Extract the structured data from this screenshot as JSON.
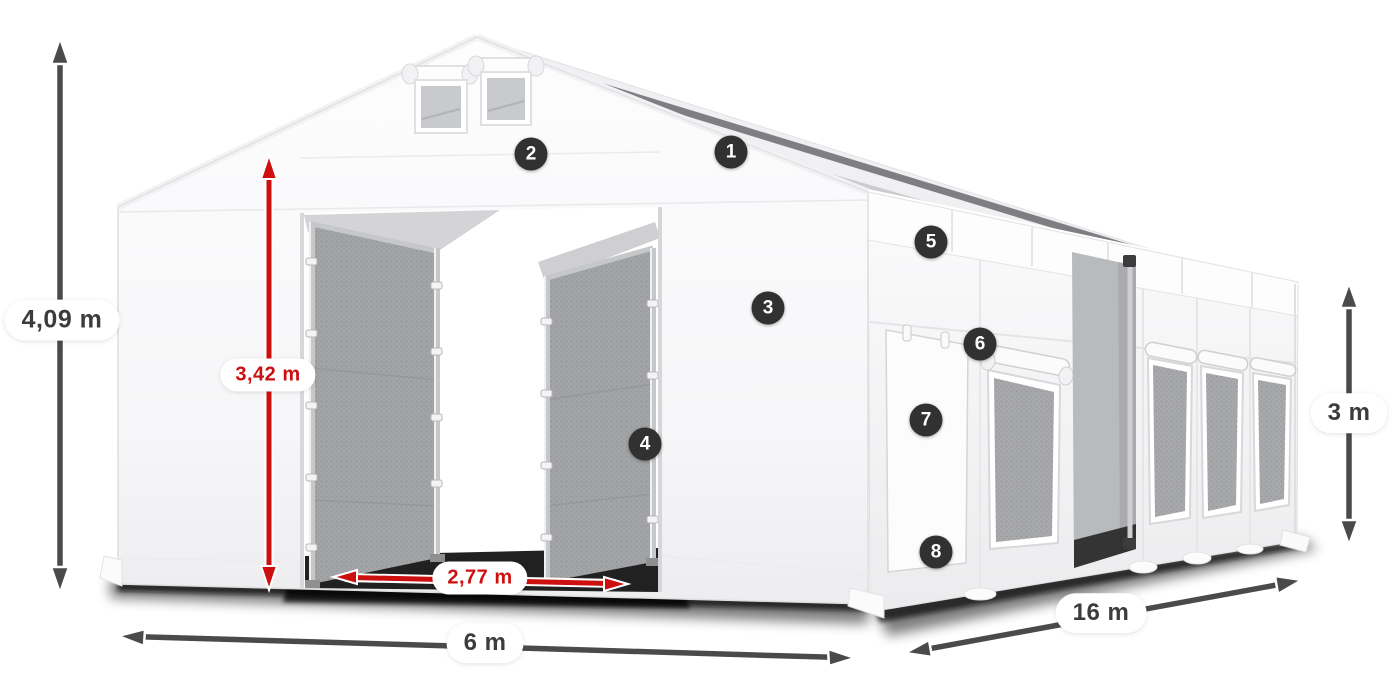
{
  "page": {
    "title": "Tent with dimensions diagram"
  },
  "dimensions": {
    "total_height": "4,09 m",
    "entrance_height": "3,42 m",
    "entrance_width": "2,77 m",
    "front_width": "6 m",
    "side_length": "16 m",
    "side_wall_height": "3 m"
  },
  "markers": [
    "1",
    "2",
    "3",
    "4",
    "5",
    "6",
    "7",
    "8"
  ],
  "colors": {
    "red_accent": "#cc0f0f",
    "arrow_gray": "#4a4a4a",
    "marker_bg": "#313131",
    "label_text": "#3c3c3c",
    "label_bg": "#ffffff"
  }
}
